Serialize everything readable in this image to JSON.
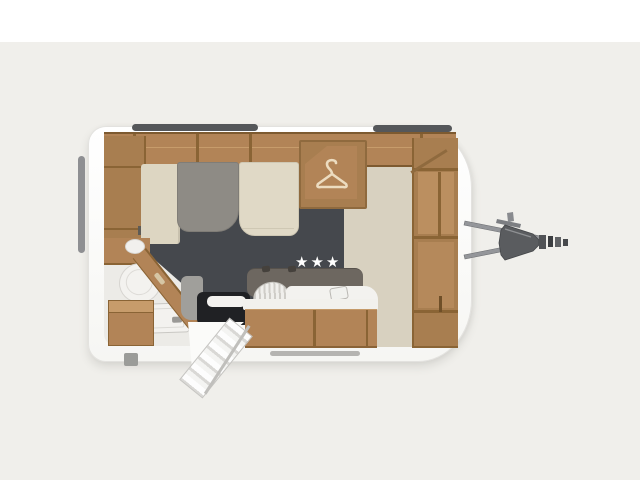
{
  "scene": {
    "description": "caravan-floorplan-top-view",
    "stars": "★★★"
  },
  "icons": {
    "wardrobe": "hanger-icon",
    "rating": "star-icon"
  },
  "colors": {
    "background_top": "#ffffff",
    "background": "#f0efeb",
    "shell": "#fbfbfa",
    "shell_edge": "#e3e2df",
    "wood": "#b28457",
    "wood_mid": "#a87e50",
    "wood_dark": "#8a6435",
    "wood_light": "#c79c6b",
    "floor_beige": "#d8d1c0",
    "floor_slate": "#45484d",
    "bath_floor": "#ecebe7",
    "bed_beige": "#ddd6c2",
    "mattress_gray": "#8e8b85",
    "mattress_beige": "#e0d9c6",
    "backrest": "#6d6760",
    "counter_black": "#202124",
    "counter_gray": "#a09f9b",
    "white_fixture": "#f3f2ef",
    "window_bar": "#55575a",
    "window_bar_light": "#8e8f92",
    "hitch": "#8e9093",
    "hitch_dark": "#5a5c5f",
    "star": "#ffffff"
  }
}
